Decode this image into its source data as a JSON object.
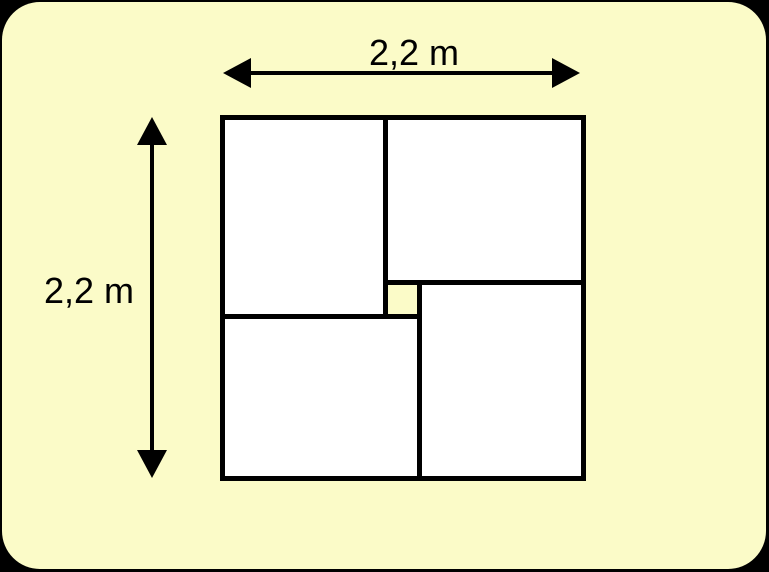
{
  "figure": {
    "width_label": "2,2 m",
    "height_label": "2,2 m"
  },
  "colors": {
    "canvas_background": "#000000",
    "panel_background": "#FBFBC8",
    "rect_fill": "#FFFFFF",
    "stroke": "#000000"
  }
}
